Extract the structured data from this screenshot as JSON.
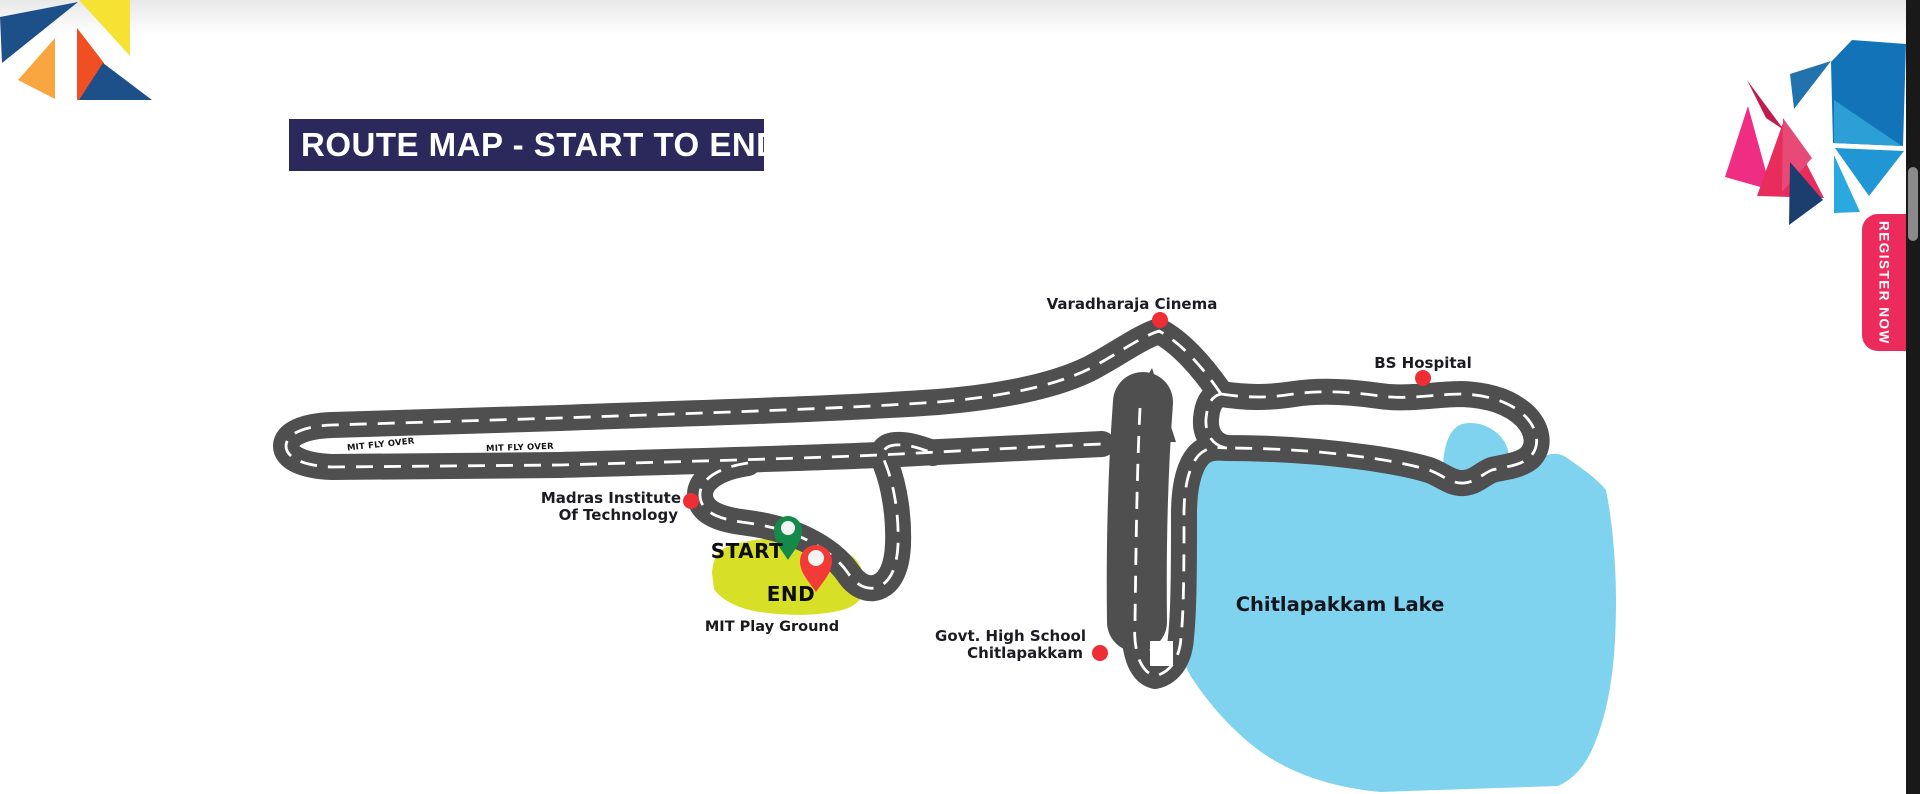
{
  "header": {
    "title": "ROUTE MAP - START TO END"
  },
  "register": {
    "label": "REGISTER NOW"
  },
  "map": {
    "pois": {
      "cinema": "Varadharaja Cinema",
      "hospital": "BS Hospital",
      "institute_line1": "Madras Institute",
      "institute_line2": "Of Technology",
      "school_line1": "Govt. High School",
      "school_line2": "Chitlapakkam"
    },
    "flyover_labels": [
      "MIT FLY OVER",
      "MIT FLY OVER"
    ],
    "markers": {
      "start": "START",
      "end": "END"
    },
    "areas": {
      "playground": "MIT Play Ground",
      "lake": "Chitlapakkam Lake"
    },
    "colors": {
      "road": "#4f4f4f",
      "lake": "#80d3ee",
      "playground": "#d7df26",
      "poi_dot": "#ee2d35",
      "start_pin": "#15894a",
      "end_pin": "#f23a36",
      "banner_bg": "#2b295c",
      "register_bg": "#ec2a5c"
    }
  }
}
